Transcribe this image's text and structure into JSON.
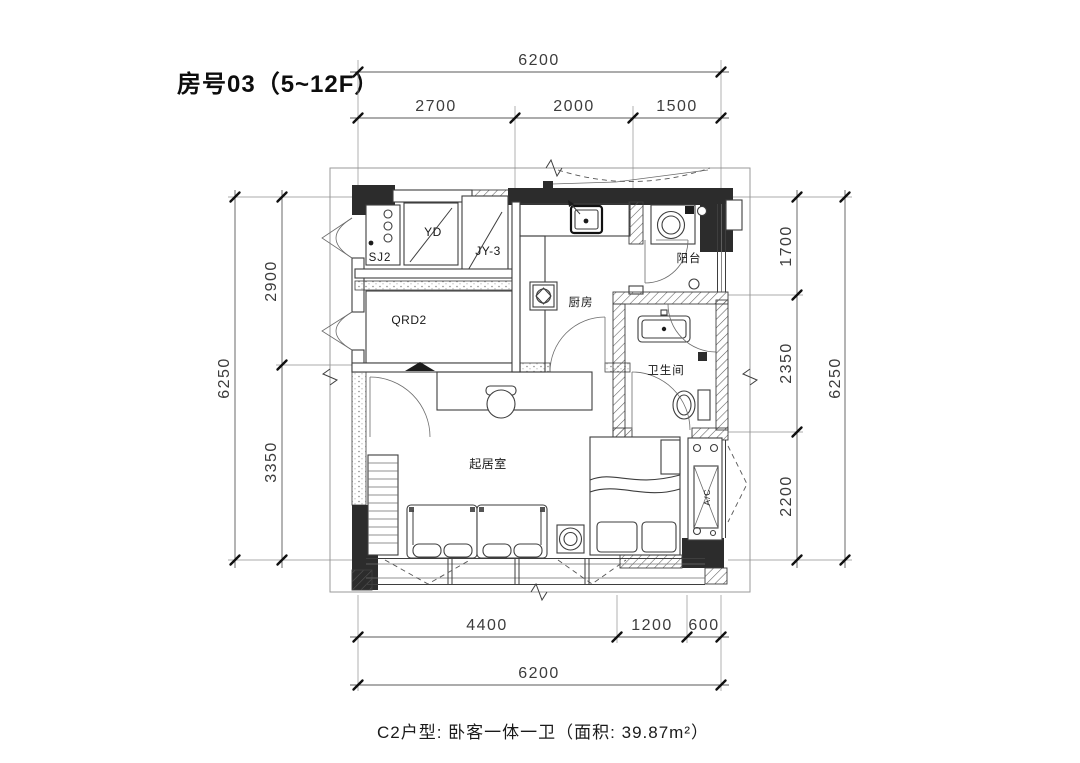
{
  "title": "房号03（5~12F）",
  "caption": "C2户型: 卧客一体一卫（面积: 39.87m²）",
  "dimensions": {
    "top": {
      "total": "6200",
      "segments": [
        "2700",
        "2000",
        "1500"
      ]
    },
    "bottom": {
      "total": "6200",
      "segments": [
        "4400",
        "1200",
        "600"
      ]
    },
    "left": {
      "total": "6250",
      "segments": [
        "2900",
        "3350"
      ]
    },
    "right": {
      "total": "6250",
      "segments": [
        "1700",
        "2350",
        "2200"
      ]
    }
  },
  "rooms": {
    "kitchen": "厨房",
    "balcony": "阳台",
    "bathroom": "卫生间",
    "living": "起居室"
  },
  "fixtures": {
    "sj2": "SJ2",
    "yd": "YD",
    "jy3": "JY-3",
    "qrd2": "QRD2",
    "ac": "A/C"
  },
  "colors": {
    "background": "#ffffff",
    "wall_fill": "#2c2c2c",
    "drawing_line": "#3e3e3e",
    "dimension_text": "#3c3c3c"
  }
}
